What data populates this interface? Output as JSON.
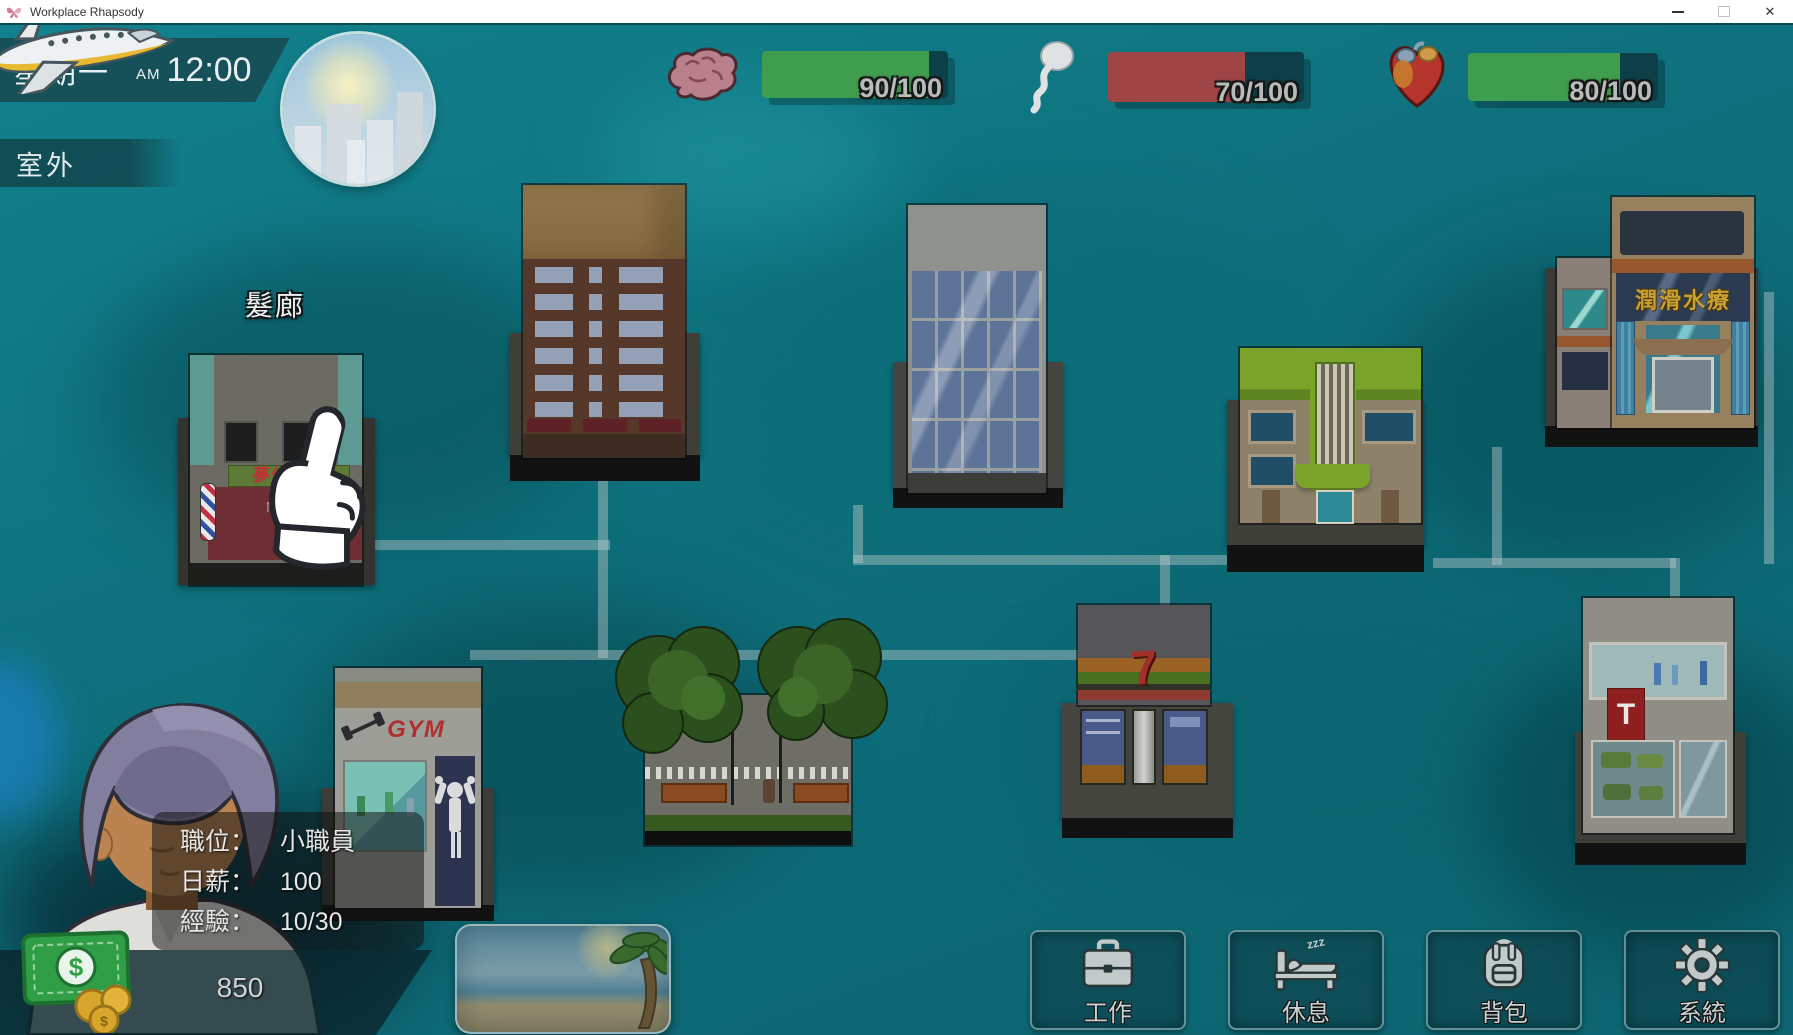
{
  "window": {
    "title": "Workplace Rhapsody",
    "close_glyph": "✕"
  },
  "hud": {
    "day": "星期一",
    "meridiem": "AM",
    "time": "12:00",
    "location": "室外",
    "stats": [
      {
        "name": "intellect",
        "icon": "brain-icon",
        "value": 90,
        "max": 100,
        "label": "90/100",
        "color": "#3f9e4d"
      },
      {
        "name": "stamina",
        "icon": "sperm-icon",
        "value": 70,
        "max": 100,
        "label": "70/100",
        "color": "#a04545"
      },
      {
        "name": "health",
        "icon": "heart-icon",
        "value": 80,
        "max": 100,
        "label": "80/100",
        "color": "#3f9e4d"
      }
    ]
  },
  "map": {
    "salon_label": "髮廊",
    "salon_sign": "夢幻髮廊",
    "salon_m": "M",
    "spa_sign": "潤滑水療",
    "gym_sign": "GYM",
    "seven_sign": "7",
    "t_sign": "T"
  },
  "player": {
    "rows": [
      {
        "label": "職位：",
        "value": "小職員"
      },
      {
        "label": "日薪：",
        "value": "100"
      },
      {
        "label": "經驗：",
        "value": "10/30"
      }
    ],
    "money": "850"
  },
  "actions": [
    {
      "id": "work",
      "icon": "briefcase-icon",
      "label": "工作"
    },
    {
      "id": "rest",
      "icon": "bed-icon",
      "label": "休息",
      "zzz": "zzz"
    },
    {
      "id": "bag",
      "icon": "backpack-icon",
      "label": "背包"
    },
    {
      "id": "system",
      "icon": "gear-icon",
      "label": "系統"
    }
  ]
}
